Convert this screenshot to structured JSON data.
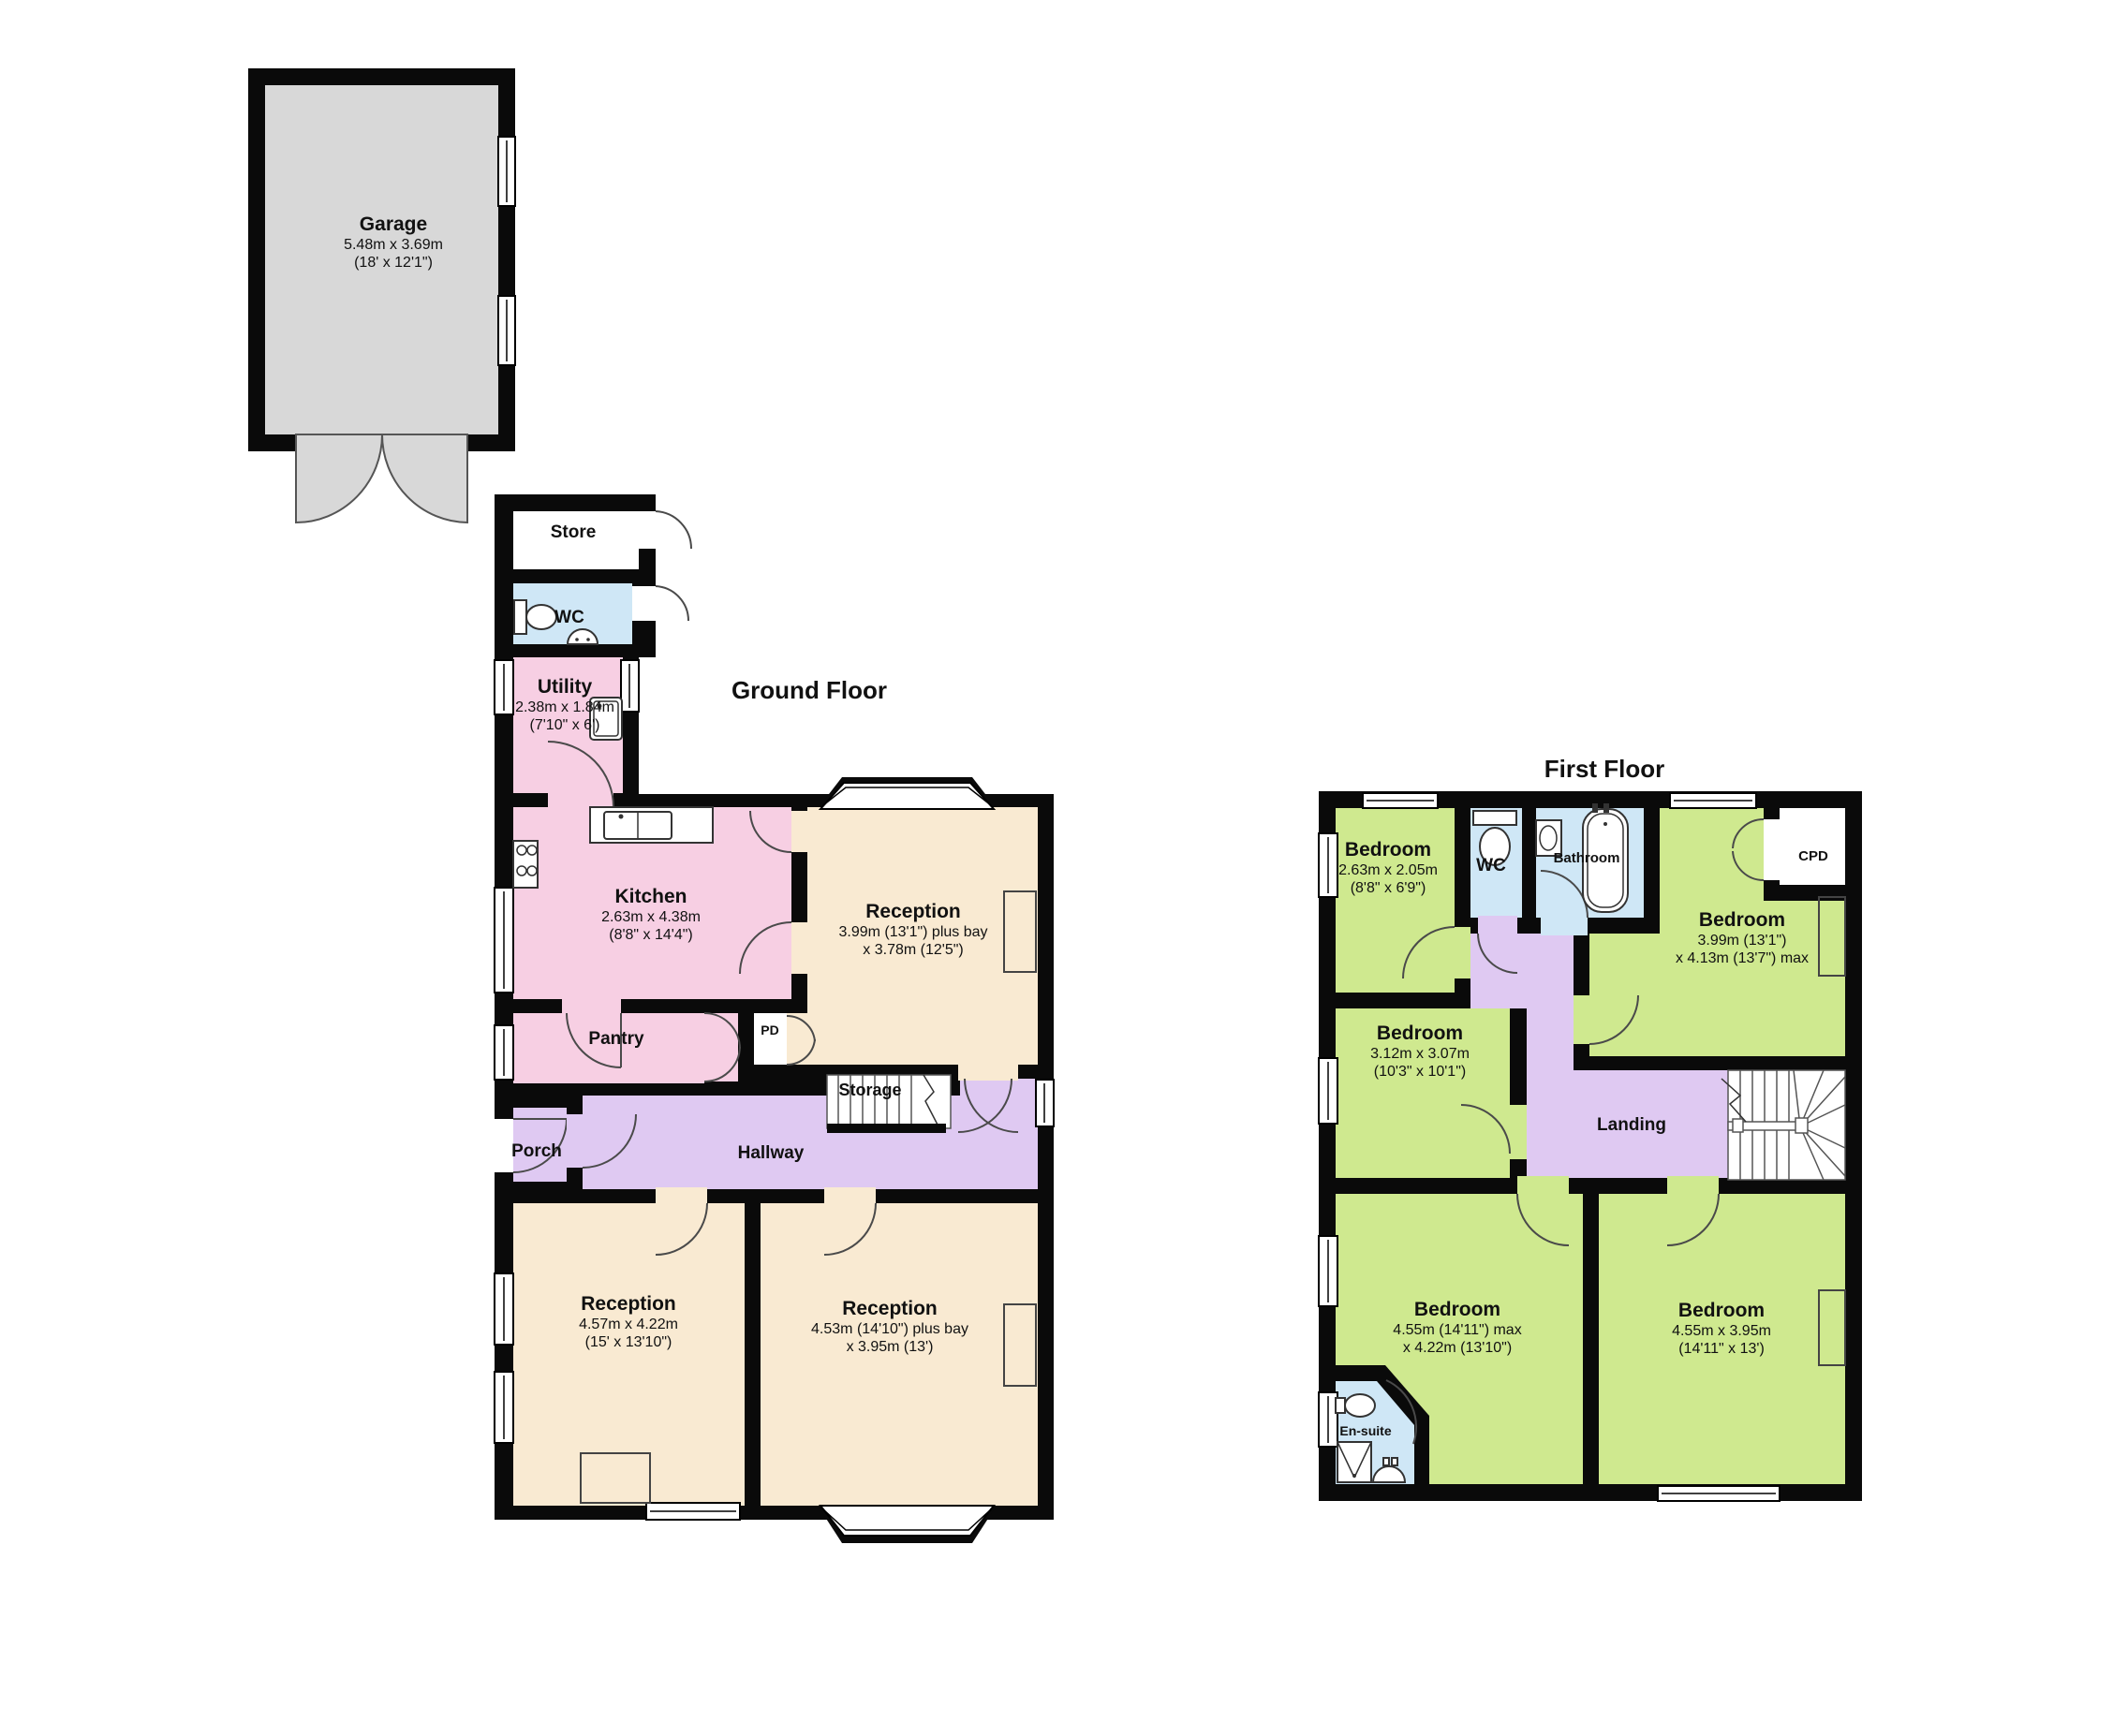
{
  "colors": {
    "wall": "#0a0a0a",
    "cream": "#f9ead2",
    "pink": "#f7cfe3",
    "purple": "#dfc9f2",
    "green": "#cfe98f",
    "blue": "#cfe7f6",
    "gray": "#d8d8d8"
  },
  "titles": {
    "ground": "Ground Floor",
    "first": "First Floor"
  },
  "garage": {
    "name": "Garage",
    "dims_m": "5.48m x 3.69m",
    "dims_ft": "(18' x 12'1\")"
  },
  "ground": {
    "store": {
      "name": "Store"
    },
    "wc": {
      "name": "WC"
    },
    "utility": {
      "name": "Utility",
      "dims_m": "2.38m x 1.84m",
      "dims_ft": "(7'10\" x 6')"
    },
    "kitchen": {
      "name": "Kitchen",
      "dims_m": "2.63m x 4.38m",
      "dims_ft": "(8'8\" x 14'4\")"
    },
    "reception_top": {
      "name": "Reception",
      "dims_m": "3.99m (13'1\") plus bay",
      "dims_ft": "x 3.78m (12'5\")"
    },
    "pantry": {
      "name": "Pantry"
    },
    "pd": {
      "name": "PD"
    },
    "storage": {
      "name": "Storage"
    },
    "porch": {
      "name": "Porch"
    },
    "hallway": {
      "name": "Hallway"
    },
    "reception_left": {
      "name": "Reception",
      "dims_m": "4.57m x 4.22m",
      "dims_ft": "(15' x 13'10\")"
    },
    "reception_right": {
      "name": "Reception",
      "dims_m": "4.53m (14'10\") plus bay",
      "dims_ft": "x 3.95m (13')"
    }
  },
  "first": {
    "bedroom_top_left": {
      "name": "Bedroom",
      "dims_m": "2.63m x 2.05m",
      "dims_ft": "(8'8\" x 6'9\")"
    },
    "wc": {
      "name": "WC"
    },
    "bathroom": {
      "name": "Bathroom"
    },
    "cpd": {
      "name": "CPD"
    },
    "bedroom_top_right": {
      "name": "Bedroom",
      "dims_m": "3.99m (13'1\")",
      "dims_ft": "x 4.13m (13'7\") max"
    },
    "bedroom_mid_left": {
      "name": "Bedroom",
      "dims_m": "3.12m x 3.07m",
      "dims_ft": "(10'3\" x 10'1\")"
    },
    "landing": {
      "name": "Landing"
    },
    "bedroom_bottom_left": {
      "name": "Bedroom",
      "dims_m": "4.55m (14'11\") max",
      "dims_ft": "x 4.22m (13'10\")"
    },
    "ensuite": {
      "name": "En-suite"
    },
    "bedroom_bottom_right": {
      "name": "Bedroom",
      "dims_m": "4.55m x 3.95m",
      "dims_ft": "(14'11\" x 13')"
    }
  }
}
